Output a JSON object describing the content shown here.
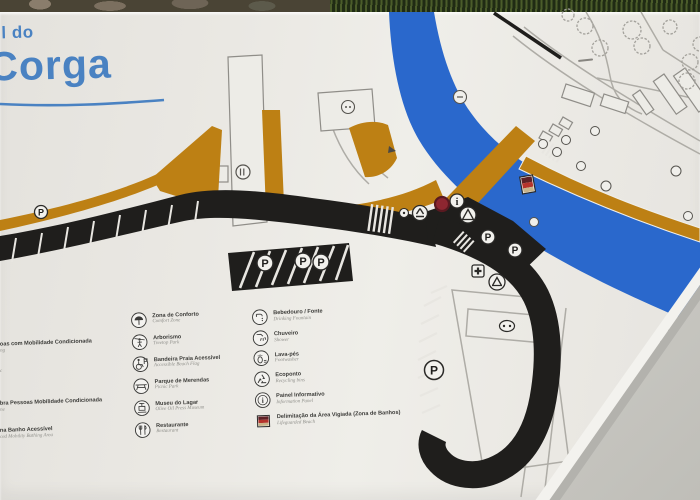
{
  "sign": {
    "title": {
      "line1": "l do",
      "line2": "Corga",
      "color": "#4a82c2"
    },
    "map": {
      "colors": {
        "river": "#2a68cc",
        "path_orange": "#bd8014",
        "road_black": "#1f1e1c",
        "board_white": "#e9e7e2"
      },
      "parking_label": "P",
      "info_label": "i"
    },
    "legend": {
      "left_column": [
        {
          "icon": "comfort-zone-icon",
          "pt": "Zona de Conforto",
          "en": "Comfort Zone"
        },
        {
          "icon": "treetop-park-icon",
          "pt": "Arborismo",
          "en": "Treetop Park"
        },
        {
          "icon": "accessible-beach-flag-icon",
          "pt": "Bandeira Praia Acessível",
          "en": "Accessible Beach Flag"
        },
        {
          "icon": "picnic-park-icon",
          "pt": "Parque de Merendas",
          "en": "Picnic Park"
        },
        {
          "icon": "olive-press-museum-icon",
          "pt": "Museu do Lagar",
          "en": "Olive Oil Press Museum"
        },
        {
          "icon": "restaurant-icon",
          "pt": "Restaurante",
          "en": "Restaurant"
        }
      ],
      "right_column": [
        {
          "icon": "drinking-fountain-icon",
          "pt": "Bebedouro / Fonte",
          "en": "Drinking Fountain"
        },
        {
          "icon": "shower-icon",
          "pt": "Chuveiro",
          "en": "Shower"
        },
        {
          "icon": "footwash-icon",
          "pt": "Lava-pés",
          "en": "Footwasher"
        },
        {
          "icon": "recycling-icon",
          "pt": "Ecoponto",
          "en": "Recycling bins"
        },
        {
          "icon": "information-panel-icon",
          "pt": "Painel Informativo",
          "en": "Information Panel"
        },
        {
          "icon": "lifeguarded-area-icon",
          "pt": "Delimitação da Área Vigiada (Zona de Banhos)",
          "en": "Lifeguarded Beach"
        }
      ],
      "left_edge_cutoff_items": [
        {
          "pt": "oas com Mobilidade Condicionada",
          "en": "ng"
        },
        {
          "pt": "",
          "en": "c"
        },
        {
          "pt": "bra Pessoas Mobilidade Condicionada",
          "en": "ne"
        },
        {
          "pt": "na Banho Acessível",
          "en": "ced Mobility Bathing Area"
        }
      ]
    }
  }
}
